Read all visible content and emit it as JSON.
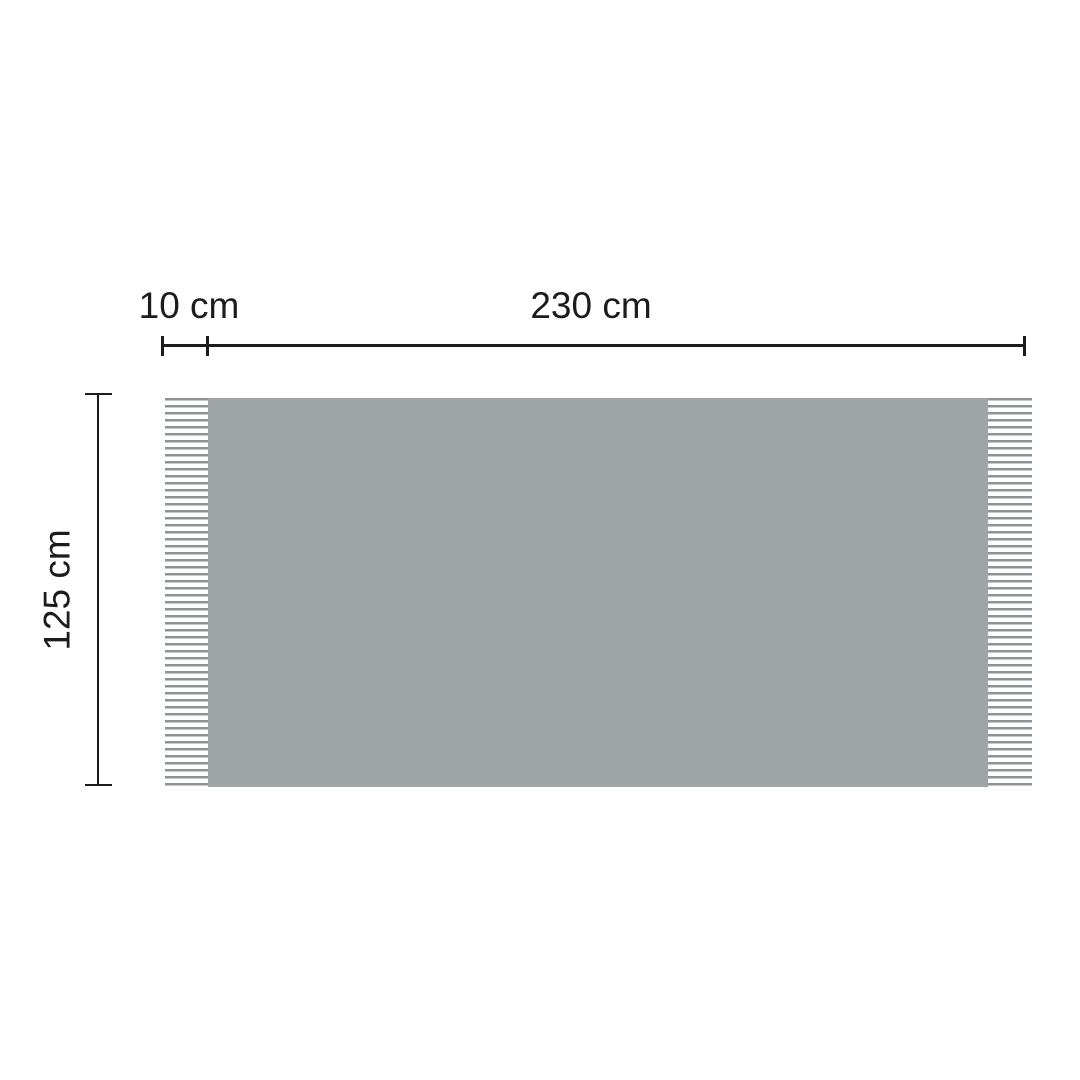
{
  "diagram": {
    "fringe_width_label": "10 cm",
    "body_width_label": "230 cm",
    "body_height_label": "125 cm"
  },
  "colors": {
    "blanket_fill": "#9fa4a7",
    "fringe_strand_dark": "#8d9295",
    "fringe_strand_light": "#c6c9cb",
    "dimension_ink": "#1c1c1c",
    "background": "#ffffff"
  }
}
